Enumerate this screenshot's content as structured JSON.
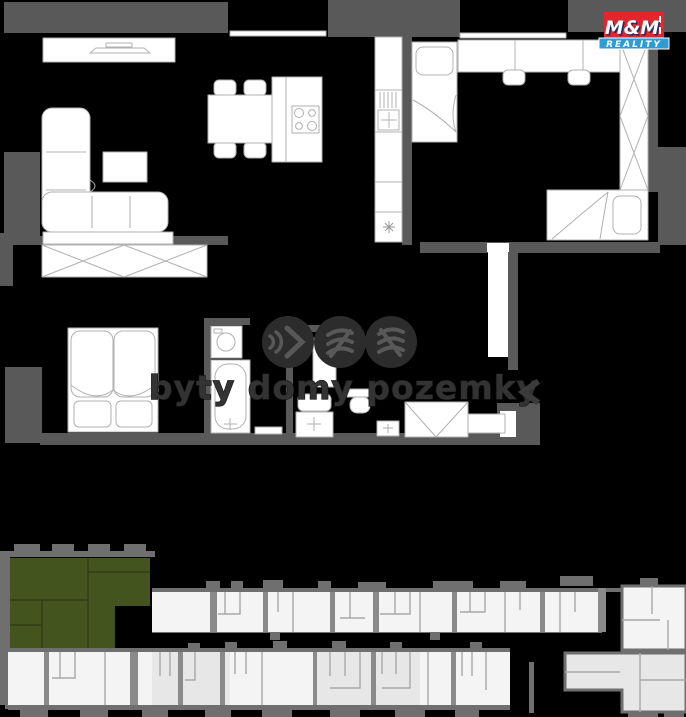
{
  "page": {
    "width": 686,
    "height": 717,
    "background": "#000000"
  },
  "logo": {
    "line1": "M&M",
    "line2": "REALITY"
  },
  "watermark": {
    "text": "byty domy pozemky",
    "icons": [
      "sound-waves-icon",
      "striped-book-icon",
      "striped-flag-icon"
    ]
  },
  "icons": {
    "gallery_prev": "chevron-left"
  },
  "colors": {
    "background": "#000000",
    "wall": "#595959",
    "furniture": "#ffffff",
    "furniture_outline": "#b0b0b0",
    "site_wall": "#6f6f6f",
    "site_unit": "#f4f4f4",
    "site_unit_shaded": "#e7e7e7",
    "highlight": "#44541e",
    "logo_red": "#e4262c",
    "logo_navy": "#1c2f66",
    "logo_blue": "#2f9bd6",
    "watermark_fill": "#333333",
    "watermark_stroke": "#141414",
    "watermark_circle": "#2c2c2c",
    "watermark_glyph": "#585858",
    "chevron": "#3b3b3b"
  },
  "floor_plan": {
    "rooms": [
      "living-room",
      "dining-area",
      "kitchen",
      "kids-room",
      "master-bedroom",
      "bathroom",
      "shower-wc",
      "hallway"
    ],
    "furniture": [
      "tv-stand",
      "corner-sofa",
      "coffee-table",
      "dining-table",
      "dining-chair",
      "kitchen-island",
      "cooktop",
      "kitchen-counter",
      "kitchen-sink",
      "single-bed",
      "desk",
      "desk-chair",
      "tall-wardrobe",
      "bedroom-wardrobe",
      "double-bed",
      "washing-machine",
      "bathtub",
      "shower",
      "toilet",
      "hand-basin",
      "hallway-closet",
      "shoe-bench"
    ]
  },
  "site_plan": {
    "highlighted_unit": "green-apartment"
  }
}
